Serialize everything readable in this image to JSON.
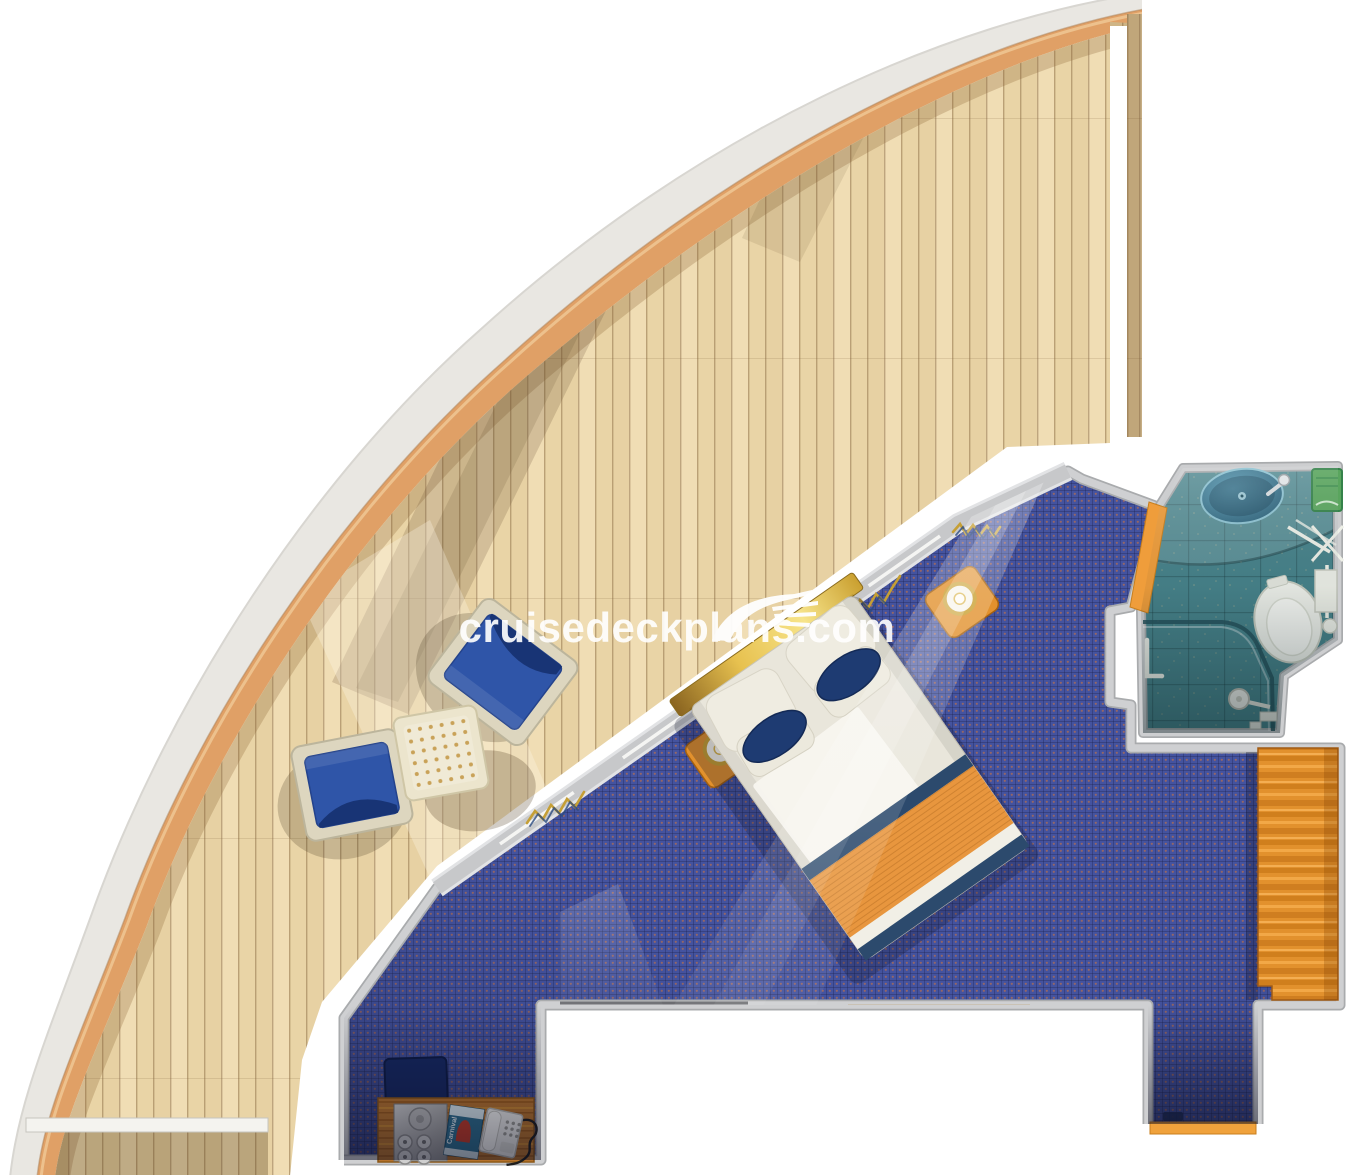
{
  "page": {
    "title": "Cruise stateroom and wraparound balcony deck plan"
  },
  "watermark": {
    "text": "cruisedeckplans.com",
    "icon": "ship-logo"
  },
  "plan": {
    "type": "cruise-cabin-floorplan",
    "rooms": [
      {
        "name": "wraparound-balcony",
        "floor": "teak-planks",
        "features": [
          "curved-hull-band",
          "hull-accent-stripe",
          "privacy-partition-top",
          "privacy-partition-bottom",
          "deck-rail"
        ],
        "furniture": [
          "deck-chair",
          "deck-chair",
          "side-table"
        ]
      },
      {
        "name": "stateroom",
        "floor": "blue-carpet",
        "furniture": [
          "double-bed",
          "nightstand-left",
          "nightstand-right",
          "wardrobe",
          "desk",
          "desk-chair",
          "vanity-tray",
          "guest-book",
          "telephone",
          "entry-threshold",
          "window-wall-curtains"
        ]
      },
      {
        "name": "bathroom",
        "floor": "teal-tile",
        "fixtures": [
          "sink",
          "faucet",
          "toilet",
          "shower-enclosure",
          "shower-head",
          "towel-rack",
          "grab-bar",
          "green-shelf"
        ]
      }
    ],
    "labels": {
      "guest_book": "Carnival"
    },
    "colors": {
      "hull_band": "#e9e7e2",
      "hull_stripe": "#e0a066",
      "deck_wood": "#ecd9ae",
      "carpet": "#44539f",
      "carpet_dot": "#c8703c",
      "bath_floor": "#47828a",
      "wall": "#c9cacc",
      "accent_wood": "#e2912d",
      "bed_linen": "#eae7dc",
      "pillow_accent": "#1e3b72",
      "foot_throw": "#e8963e",
      "chair_blue": "#2f55a8",
      "watermark": "#ffffff"
    }
  }
}
